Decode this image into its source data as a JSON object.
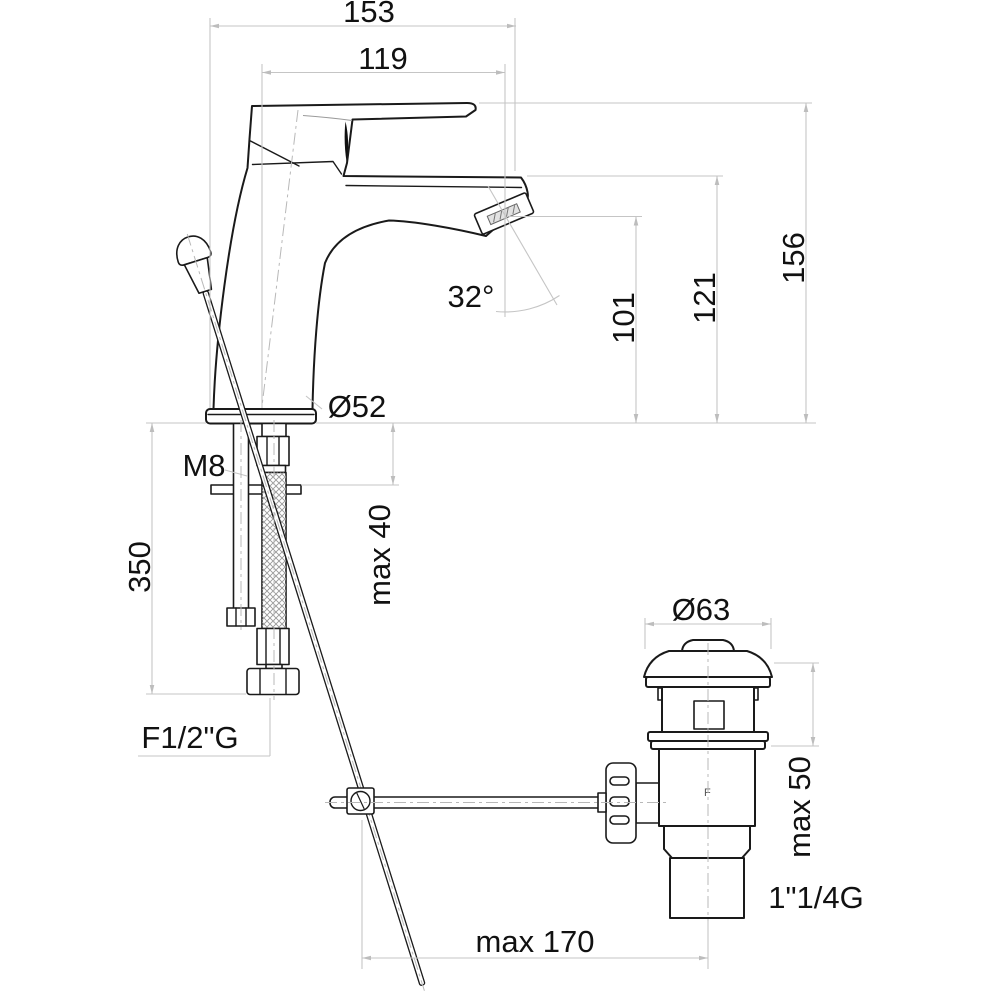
{
  "dimensions": {
    "overall_width": "153",
    "spout_reach": "119",
    "overall_height": "156",
    "spout_height": "121",
    "outlet_height": "101",
    "outlet_angle": "32°",
    "body_diameter": "Ø52",
    "fixing_thread": "M8",
    "hose_length": "350",
    "deck_thickness_max": "max 40",
    "hose_nut_thread": "F1/2\"G",
    "waste_flange_diameter": "Ø63",
    "basin_thickness_max": "max 50",
    "waste_thread": "1\"1/4G",
    "rod_reach_max": "max 170"
  },
  "drain": {
    "brand_mark": "F"
  },
  "colors": {
    "outline": "#1a1a1a",
    "dimension_lines": "#c5c5c5",
    "centerlines": "#b8b8b8",
    "text": "#111111",
    "background": "#ffffff"
  }
}
